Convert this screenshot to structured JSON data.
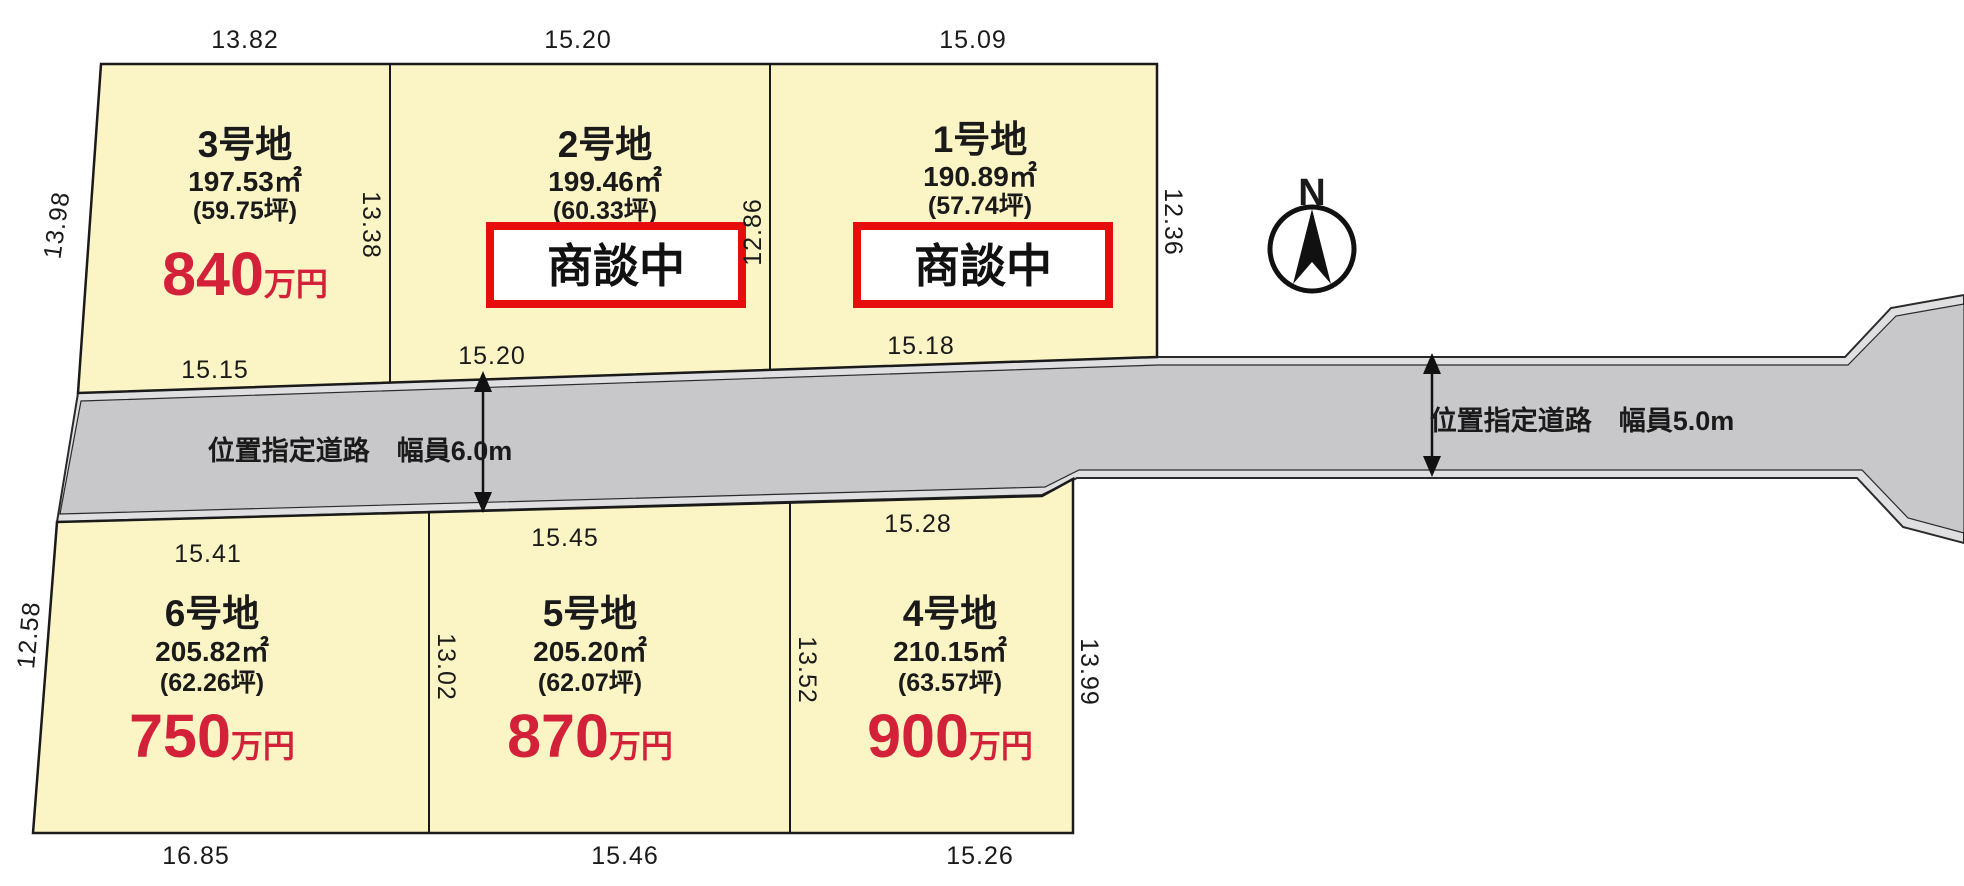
{
  "title": "宅地分譲区画図",
  "colors": {
    "plot_fill": "#FBF5C6",
    "road_fill": "#C8C8CA",
    "road_edge_band": "#DFDFE1",
    "outline": "#1A1A1A",
    "price_red": "#D4213A",
    "badge_border_red": "#E60D0C"
  },
  "compass": {
    "label": "N"
  },
  "roads": {
    "left_label": "位置指定道路　幅員6.0m",
    "right_label": "位置指定道路　幅員5.0m"
  },
  "plots": [
    {
      "name": "1号地",
      "area": "190.89㎡",
      "tsubo": "(57.74坪)",
      "status": "商談中"
    },
    {
      "name": "2号地",
      "area": "199.46㎡",
      "tsubo": "(60.33坪)",
      "status": "商談中"
    },
    {
      "name": "3号地",
      "area": "197.53㎡",
      "tsubo": "(59.75坪)",
      "price": "840",
      "price_unit": "万円"
    },
    {
      "name": "4号地",
      "area": "210.15㎡",
      "tsubo": "(63.57坪)",
      "price": "900",
      "price_unit": "万円"
    },
    {
      "name": "5号地",
      "area": "205.20㎡",
      "tsubo": "(62.07坪)",
      "price": "870",
      "price_unit": "万円"
    },
    {
      "name": "6号地",
      "area": "205.82㎡",
      "tsubo": "(62.26坪)",
      "price": "750",
      "price_unit": "万円"
    }
  ],
  "dimensions": {
    "top": [
      "13.82",
      "15.20",
      "15.09"
    ],
    "road_upper": [
      "15.15",
      "15.20",
      "15.18"
    ],
    "road_lower": [
      "15.41",
      "15.45",
      "15.28"
    ],
    "bottom": [
      "16.85",
      "15.46",
      "15.26"
    ],
    "vertical_top": [
      "13.98",
      "13.38",
      "12.86",
      "12.36"
    ],
    "vertical_bottom": [
      "12.58",
      "13.02",
      "13.52",
      "13.99"
    ]
  }
}
